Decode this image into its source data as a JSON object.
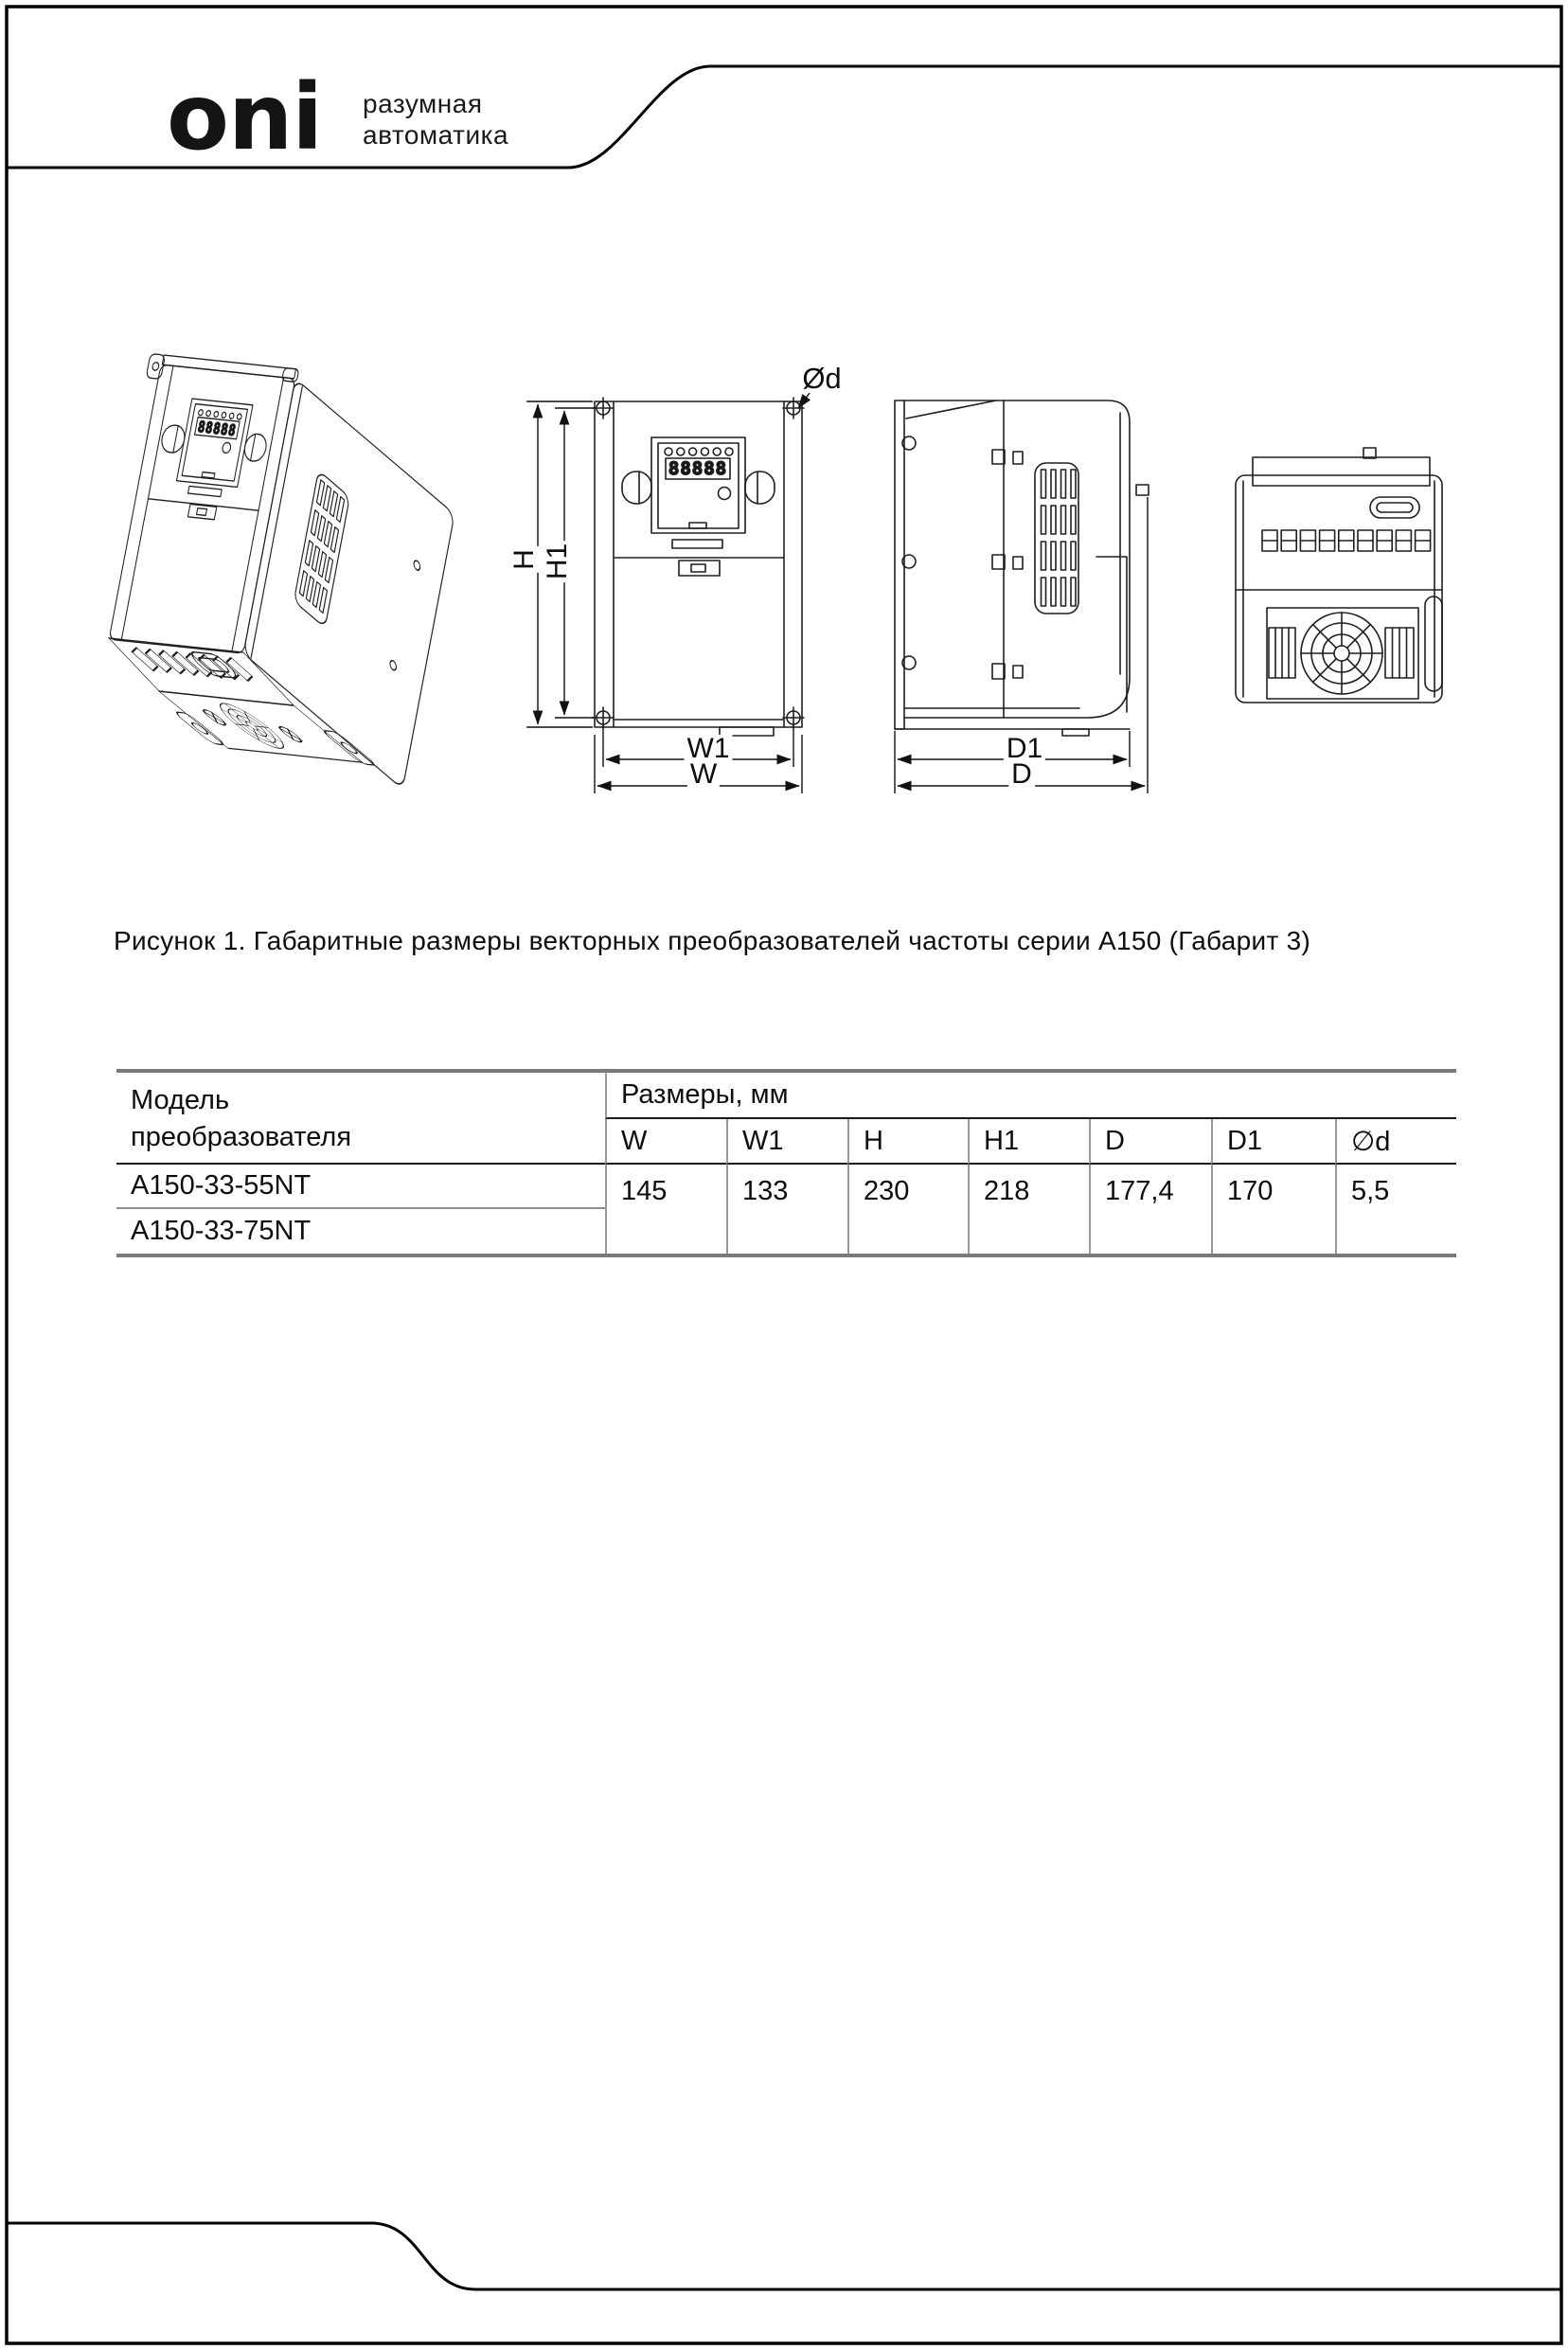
{
  "brand": {
    "logo": "oni",
    "tagline_line1": "разумная",
    "tagline_line2": "автоматика"
  },
  "figure": {
    "caption": "Рисунок 1. Габаритные размеры векторных преобразователей частоты серии А150 (Габарит 3)"
  },
  "drawings": {
    "display_value": "88888",
    "dim_labels": {
      "h": "H",
      "h1": "H1",
      "w": "W",
      "w1": "W1",
      "d": "D",
      "d1": "D1",
      "diameter": "Ød"
    }
  },
  "table": {
    "model_header": "Модель\nпреобразователя",
    "size_header": "Размеры, мм",
    "columns": [
      "W",
      "W1",
      "H",
      "H1",
      "D",
      "D1",
      "∅d"
    ],
    "rows": [
      {
        "model": "A150-33-55NT"
      },
      {
        "model": "A150-33-75NT"
      }
    ],
    "values": [
      "145",
      "133",
      "230",
      "218",
      "177,4",
      "170",
      "5,5"
    ]
  },
  "colors": {
    "line": "#1f1f1f",
    "table_border": "#7a7a7a"
  }
}
